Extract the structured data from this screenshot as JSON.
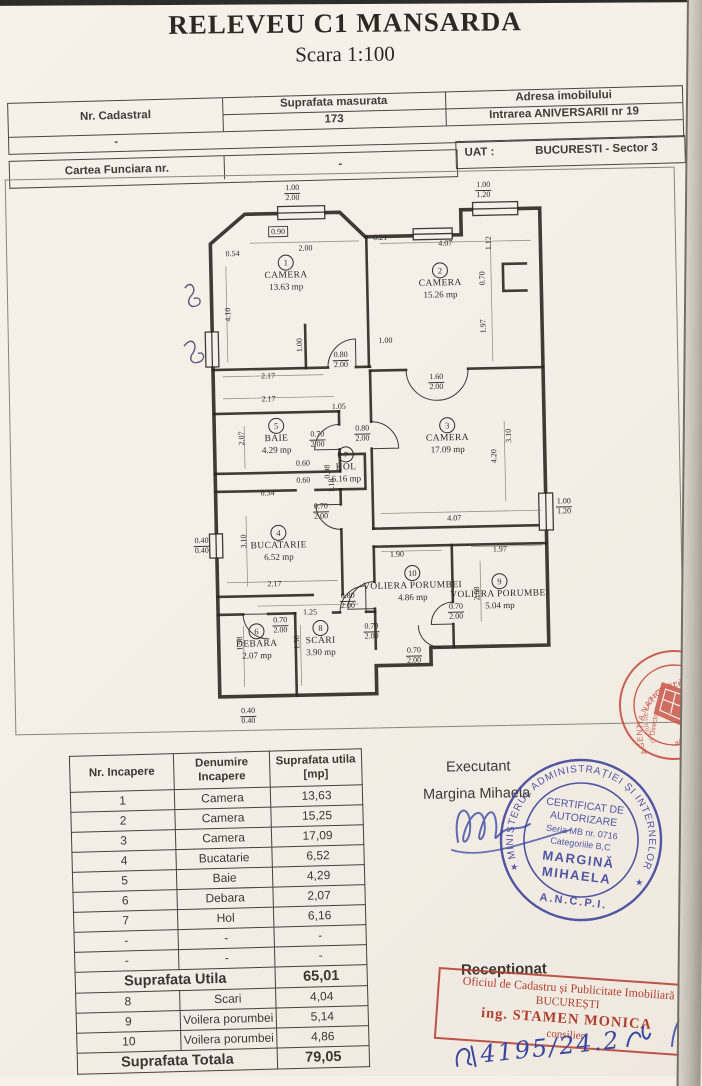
{
  "page": {
    "title": "RELEVEU C1 MANSARDA",
    "subtitle": "Scara 1:100"
  },
  "header": {
    "nr_cadastral_label": "Nr. Cadastral",
    "nr_cadastral_value": "-",
    "suprafata_label": "Suprafata masurata",
    "suprafata_value": "173",
    "adresa_label": "Adresa imobilului",
    "adresa_value": "Intrarea ANIVERSARII nr 19",
    "cartea_label": "Cartea Funciara nr.",
    "cartea_value": "-",
    "uat_label": "UAT :",
    "uat_value": "BUCURESTI - Sector 3"
  },
  "plan": {
    "rooms": [
      {
        "num": "1",
        "name": "CAMERA",
        "area": "13.63 mp",
        "x": 105,
        "y": 87
      },
      {
        "num": "2",
        "name": "CAMERA",
        "area": "15.26 mp",
        "x": 259,
        "y": 98
      },
      {
        "num": "3",
        "name": "CAMERA",
        "area": "17.09 mp",
        "x": 263,
        "y": 253
      },
      {
        "num": "4",
        "name": "BUCATARIE",
        "area": "6.52 mp",
        "x": 92,
        "y": 357
      },
      {
        "num": "5",
        "name": "BAIE",
        "area": "4.29 mp",
        "x": 92,
        "y": 250
      },
      {
        "num": "6",
        "name": "DEBARA",
        "area": "2.07 mp",
        "x": 68,
        "y": 455
      },
      {
        "num": "7",
        "name": "HOL",
        "area": "6.16 mp",
        "x": 161,
        "y": 280
      },
      {
        "num": "8",
        "name": "SCARI",
        "area": "3.90 mp",
        "x": 132,
        "y": 453
      },
      {
        "num": "9",
        "name": "VOLIERA PORUMBEI",
        "area": "5.04 mp",
        "x": 312,
        "y": 410
      },
      {
        "num": "10",
        "name": "VOLIERA PORUMBEI",
        "area": "4.86 mp",
        "x": 225,
        "y": 400
      }
    ],
    "dims": [
      {
        "t": "0.90",
        "x": 98,
        "y": 46,
        "box": true
      },
      {
        "t": "2.00",
        "x": 125,
        "y": 63
      },
      {
        "t": "0.54",
        "x": 52,
        "y": 67
      },
      {
        "t": "0.21",
        "x": 200,
        "y": 54
      },
      {
        "t": "4.07",
        "x": 265,
        "y": 61
      },
      {
        "t": "2.17",
        "x": 85,
        "y": 190
      },
      {
        "t": "1.00",
        "x": 203,
        "y": 157
      },
      {
        "t": "2.17",
        "x": 85,
        "y": 213
      },
      {
        "t": "1.05",
        "x": 155,
        "y": 222
      },
      {
        "t": "0.60",
        "x": 118,
        "y": 278
      },
      {
        "t": "0.60",
        "x": 118,
        "y": 295
      },
      {
        "t": "0.34",
        "x": 82,
        "y": 307
      },
      {
        "t": "2.17",
        "x": 87,
        "y": 398
      },
      {
        "t": "4.07",
        "x": 268,
        "y": 336
      },
      {
        "t": "1.90",
        "x": 210,
        "y": 371
      },
      {
        "t": "1.97",
        "x": 313,
        "y": 368
      },
      {
        "t": "1.25",
        "x": 122,
        "y": 427
      }
    ],
    "vdims": [
      {
        "t": "4.10",
        "x": 46,
        "y": 128
      },
      {
        "t": "1.12",
        "x": 308,
        "y": 62
      },
      {
        "t": "0.70",
        "x": 301,
        "y": 97
      },
      {
        "t": "1.97",
        "x": 301,
        "y": 145
      },
      {
        "t": "1.00",
        "x": 117,
        "y": 160
      },
      {
        "t": "2.07",
        "x": 57,
        "y": 252
      },
      {
        "t": "0.98",
        "x": 142,
        "y": 287
      },
      {
        "t": "1.18",
        "x": 146,
        "y": 301
      },
      {
        "t": "3.10",
        "x": 57,
        "y": 355
      },
      {
        "t": "3.10",
        "x": 324,
        "y": 255
      },
      {
        "t": "4.20",
        "x": 309,
        "y": 275
      },
      {
        "t": "1.98",
        "x": 51,
        "y": 457
      },
      {
        "t": "1.98",
        "x": 108,
        "y": 457
      },
      {
        "t": "2.58",
        "x": 289,
        "y": 412
      }
    ],
    "fracs": [
      {
        "a": "1.00",
        "b": "2.00",
        "x": 113,
        "y": 8
      },
      {
        "a": "1.00",
        "b": "1.20",
        "x": 304,
        "y": 9
      },
      {
        "a": "0.80",
        "b": "2.00",
        "x": 158,
        "y": 176
      },
      {
        "a": "1.60",
        "b": "2.00",
        "x": 253,
        "y": 200
      },
      {
        "a": "0.80",
        "b": "2.00",
        "x": 178,
        "y": 250
      },
      {
        "a": "0.70",
        "b": "2.00",
        "x": 133,
        "y": 255
      },
      {
        "a": "0.70",
        "b": "2.00",
        "x": 135,
        "y": 327
      },
      {
        "a": "1.00",
        "b": "1.20",
        "x": 378,
        "y": 327
      },
      {
        "a": "0.40",
        "b": "0.40",
        "x": 15,
        "y": 359
      },
      {
        "a": "0.80",
        "b": "2.00",
        "x": 160,
        "y": 417
      },
      {
        "a": "0.70",
        "b": "2.00",
        "x": 92,
        "y": 440
      },
      {
        "a": "0.70",
        "b": "2.00",
        "x": 183,
        "y": 448
      },
      {
        "a": "0.70",
        "b": "2.00",
        "x": 268,
        "y": 430
      },
      {
        "a": "0.70",
        "b": "2.00",
        "x": 225,
        "y": 473
      },
      {
        "a": "0.40",
        "b": "0.40",
        "x": 58,
        "y": 530
      }
    ]
  },
  "area_table": {
    "col_headers": [
      "Nr. Incapere",
      "Denumire\nIncapere",
      "Suprafata utila\n[mp]"
    ],
    "rows": [
      [
        "1",
        "Camera",
        "13,63"
      ],
      [
        "2",
        "Camera",
        "15,25"
      ],
      [
        "3",
        "Camera",
        "17,09"
      ],
      [
        "4",
        "Bucatarie",
        "6,52"
      ],
      [
        "5",
        "Baie",
        "4,29"
      ],
      [
        "6",
        "Debara",
        "2,07"
      ],
      [
        "7",
        "Hol",
        "6,16"
      ],
      [
        "-",
        "-",
        "-"
      ],
      [
        "-",
        "-",
        "-"
      ]
    ],
    "subtotal_label": "Suprafata Utila",
    "subtotal_value": "65,01",
    "rows2": [
      [
        "8",
        "Scari",
        "4,04"
      ],
      [
        "9",
        "Voilera porumbei",
        "5,14"
      ],
      [
        "10",
        "Voilera porumbei",
        "4,86"
      ]
    ],
    "total_label": "Suprafata Totala",
    "total_value": "79,05"
  },
  "executant": {
    "label": "Executant",
    "name": "Margina Mihaela"
  },
  "receptionat": {
    "label": "Receptionat"
  },
  "stamp_blue": {
    "ring_top": "MINISTERUL ADMINISTRAȚIEI ȘI INTERNELOR",
    "ring_bottom": "A.N.C.P.I.",
    "line1": "CERTIFICAT DE",
    "line2": "AUTORIZARE",
    "line3": "Seria MB nr. 0716",
    "line4": "Categoriile B,C",
    "line5": "MARGINĂ",
    "line6": "MIHAELA",
    "color": "#3c429a"
  },
  "stamp_red_round": {
    "ring_outer": "AGENȚIA NAȚIONALĂ DE CADASTRU",
    "ring_inner": "OFICIUL DE CADASTRU ȘI PUBLICITATE",
    "word_bottom": "IMOBILIARĂ",
    "word_director": "Director",
    "word_city": "BUCUREȘTI",
    "color": "#c4473a"
  },
  "stamp_red_rect": {
    "line1": "Oficiul de Cadastru și Publicitate Imobiliară",
    "line2": "BUCUREȘTI",
    "line3": "ing. STAMEN MONICA",
    "line4": "consilier",
    "color": "#b13f2e"
  },
  "handwritten_note": "4195/24.2"
}
